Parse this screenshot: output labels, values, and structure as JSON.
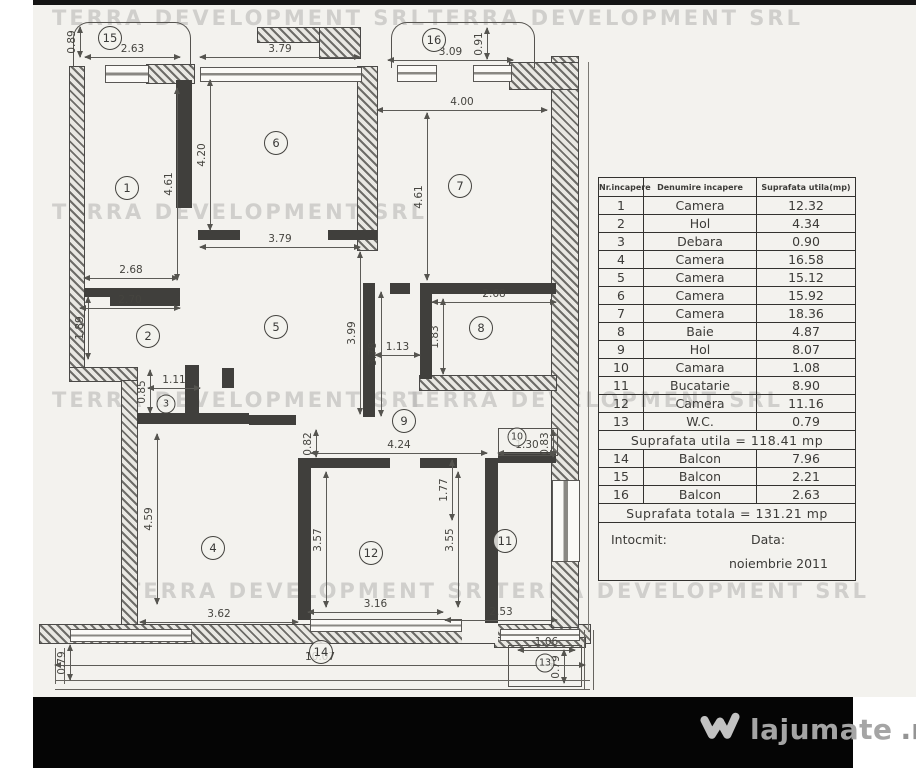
{
  "watermark_text": "TERRA DEVELOPMENT SRL",
  "logo": {
    "text": "lajumate",
    "suffix": ".ro"
  },
  "table": {
    "headers": [
      "Nr.incapere",
      "Denumire incapere",
      "Suprafata utila(mp)"
    ],
    "rows": [
      {
        "nr": "1",
        "name": "Camera",
        "area": "12.32"
      },
      {
        "nr": "2",
        "name": "Hol",
        "area": "4.34"
      },
      {
        "nr": "3",
        "name": "Debara",
        "area": "0.90"
      },
      {
        "nr": "4",
        "name": "Camera",
        "area": "16.58"
      },
      {
        "nr": "5",
        "name": "Camera",
        "area": "15.12"
      },
      {
        "nr": "6",
        "name": "Camera",
        "area": "15.92"
      },
      {
        "nr": "7",
        "name": "Camera",
        "area": "18.36"
      },
      {
        "nr": "8",
        "name": "Baie",
        "area": "4.87"
      },
      {
        "nr": "9",
        "name": "Hol",
        "area": "8.07"
      },
      {
        "nr": "10",
        "name": "Camara",
        "area": "1.08"
      },
      {
        "nr": "11",
        "name": "Bucatarie",
        "area": "8.90"
      },
      {
        "nr": "12",
        "name": "Camera",
        "area": "11.16"
      },
      {
        "nr": "13",
        "name": "W.C.",
        "area": "0.79"
      }
    ],
    "subtotal": "Suprafata utila  =  118.41  mp",
    "balcony_rows": [
      {
        "nr": "14",
        "name": "Balcon",
        "area": "7.96"
      },
      {
        "nr": "15",
        "name": "Balcon",
        "area": "2.21"
      },
      {
        "nr": "16",
        "name": "Balcon",
        "area": "2.63"
      }
    ],
    "total": "Suprafata totala  =  131.21  mp",
    "footer": {
      "intocmit": "Intocmit:",
      "data_label": "Data:",
      "date": "noiembrie  2011"
    }
  },
  "plan": {
    "rooms": [
      {
        "n": "1",
        "x": 127,
        "y": 188
      },
      {
        "n": "2",
        "x": 148,
        "y": 336
      },
      {
        "n": "3",
        "x": 166,
        "y": 404,
        "sm": true
      },
      {
        "n": "4",
        "x": 213,
        "y": 548
      },
      {
        "n": "5",
        "x": 276,
        "y": 327
      },
      {
        "n": "6",
        "x": 276,
        "y": 143
      },
      {
        "n": "7",
        "x": 460,
        "y": 186
      },
      {
        "n": "8",
        "x": 481,
        "y": 328
      },
      {
        "n": "9",
        "x": 404,
        "y": 421
      },
      {
        "n": "10",
        "x": 517,
        "y": 437,
        "sm": true
      },
      {
        "n": "11",
        "x": 505,
        "y": 541
      },
      {
        "n": "12",
        "x": 371,
        "y": 553
      },
      {
        "n": "13",
        "x": 545,
        "y": 663,
        "sm": true
      },
      {
        "n": "14",
        "x": 321,
        "y": 652
      },
      {
        "n": "15",
        "x": 110,
        "y": 38
      },
      {
        "n": "16",
        "x": 434,
        "y": 40
      }
    ],
    "dims": [
      {
        "t": "2.63",
        "o": "h",
        "x": 85,
        "y": 57,
        "len": 95
      },
      {
        "t": "3.79",
        "o": "h",
        "x": 200,
        "y": 57,
        "len": 160
      },
      {
        "t": "3.09",
        "o": "h",
        "x": 388,
        "y": 60,
        "len": 125
      },
      {
        "t": "4.00",
        "o": "h",
        "x": 377,
        "y": 110,
        "len": 170
      },
      {
        "t": "3.79",
        "o": "h",
        "x": 200,
        "y": 247,
        "len": 160
      },
      {
        "t": "2.68",
        "o": "h",
        "x": 84,
        "y": 278,
        "len": 94
      },
      {
        "t": "2.70",
        "o": "h",
        "x": 80,
        "y": 308,
        "len": 100
      },
      {
        "t": "1.11",
        "o": "h",
        "x": 148,
        "y": 388,
        "len": 52
      },
      {
        "t": "1.13",
        "o": "h",
        "x": 375,
        "y": 355,
        "len": 45
      },
      {
        "t": "2.68",
        "o": "h",
        "x": 432,
        "y": 302,
        "len": 124
      },
      {
        "t": "4.24",
        "o": "h",
        "x": 311,
        "y": 453,
        "len": 176
      },
      {
        "t": "1.30",
        "o": "h",
        "x": 498,
        "y": 453,
        "len": 58
      },
      {
        "t": "3.62",
        "o": "h",
        "x": 140,
        "y": 622,
        "len": 158
      },
      {
        "t": "3.16",
        "o": "h",
        "x": 308,
        "y": 612,
        "len": 135
      },
      {
        "t": "2.53",
        "o": "h",
        "x": 445,
        "y": 620,
        "len": 112
      },
      {
        "t": "1.06",
        "o": "h",
        "x": 518,
        "y": 650,
        "len": 57
      },
      {
        "t": "10.07",
        "o": "h",
        "x": 55,
        "y": 665,
        "len": 530
      },
      {
        "t": "0.89",
        "o": "v",
        "x": 80,
        "y": 27,
        "len": 30
      },
      {
        "t": "0.91",
        "o": "v",
        "x": 487,
        "y": 28,
        "len": 31
      },
      {
        "t": "4.20",
        "o": "v",
        "x": 210,
        "y": 80,
        "len": 150
      },
      {
        "t": "4.61",
        "o": "v",
        "x": 177,
        "y": 88,
        "len": 192
      },
      {
        "t": "4.61",
        "o": "v",
        "x": 427,
        "y": 113,
        "len": 167
      },
      {
        "t": "1.89",
        "o": "v",
        "x": 88,
        "y": 297,
        "len": 62
      },
      {
        "t": "0.85",
        "o": "v",
        "x": 150,
        "y": 370,
        "len": 43
      },
      {
        "t": "3.99",
        "o": "v",
        "x": 360,
        "y": 252,
        "len": 162
      },
      {
        "t": "3.78",
        "o": "v",
        "x": 381,
        "y": 292,
        "len": 124
      },
      {
        "t": "1.83",
        "o": "v",
        "x": 443,
        "y": 299,
        "len": 75
      },
      {
        "t": "0.82",
        "o": "v",
        "x": 316,
        "y": 430,
        "len": 27
      },
      {
        "t": "0.83",
        "o": "v",
        "x": 553,
        "y": 430,
        "len": 27
      },
      {
        "t": "1.77",
        "o": "v",
        "x": 452,
        "y": 460,
        "len": 60
      },
      {
        "t": "4.59",
        "o": "v",
        "x": 157,
        "y": 434,
        "len": 170
      },
      {
        "t": "3.57",
        "o": "v",
        "x": 326,
        "y": 472,
        "len": 135
      },
      {
        "t": "3.55",
        "o": "v",
        "x": 458,
        "y": 472,
        "len": 135
      },
      {
        "t": "0.79",
        "o": "v",
        "x": 70,
        "y": 645,
        "len": 35
      },
      {
        "t": "0.79",
        "o": "v",
        "x": 564,
        "y": 650,
        "len": 33
      }
    ],
    "watermarks": [
      {
        "x": 52,
        "y": 6
      },
      {
        "x": 428,
        "y": 6
      },
      {
        "x": 52,
        "y": 200
      },
      {
        "x": 52,
        "y": 388
      },
      {
        "x": 408,
        "y": 388
      },
      {
        "x": 126,
        "y": 579
      },
      {
        "x": 494,
        "y": 579
      }
    ]
  }
}
